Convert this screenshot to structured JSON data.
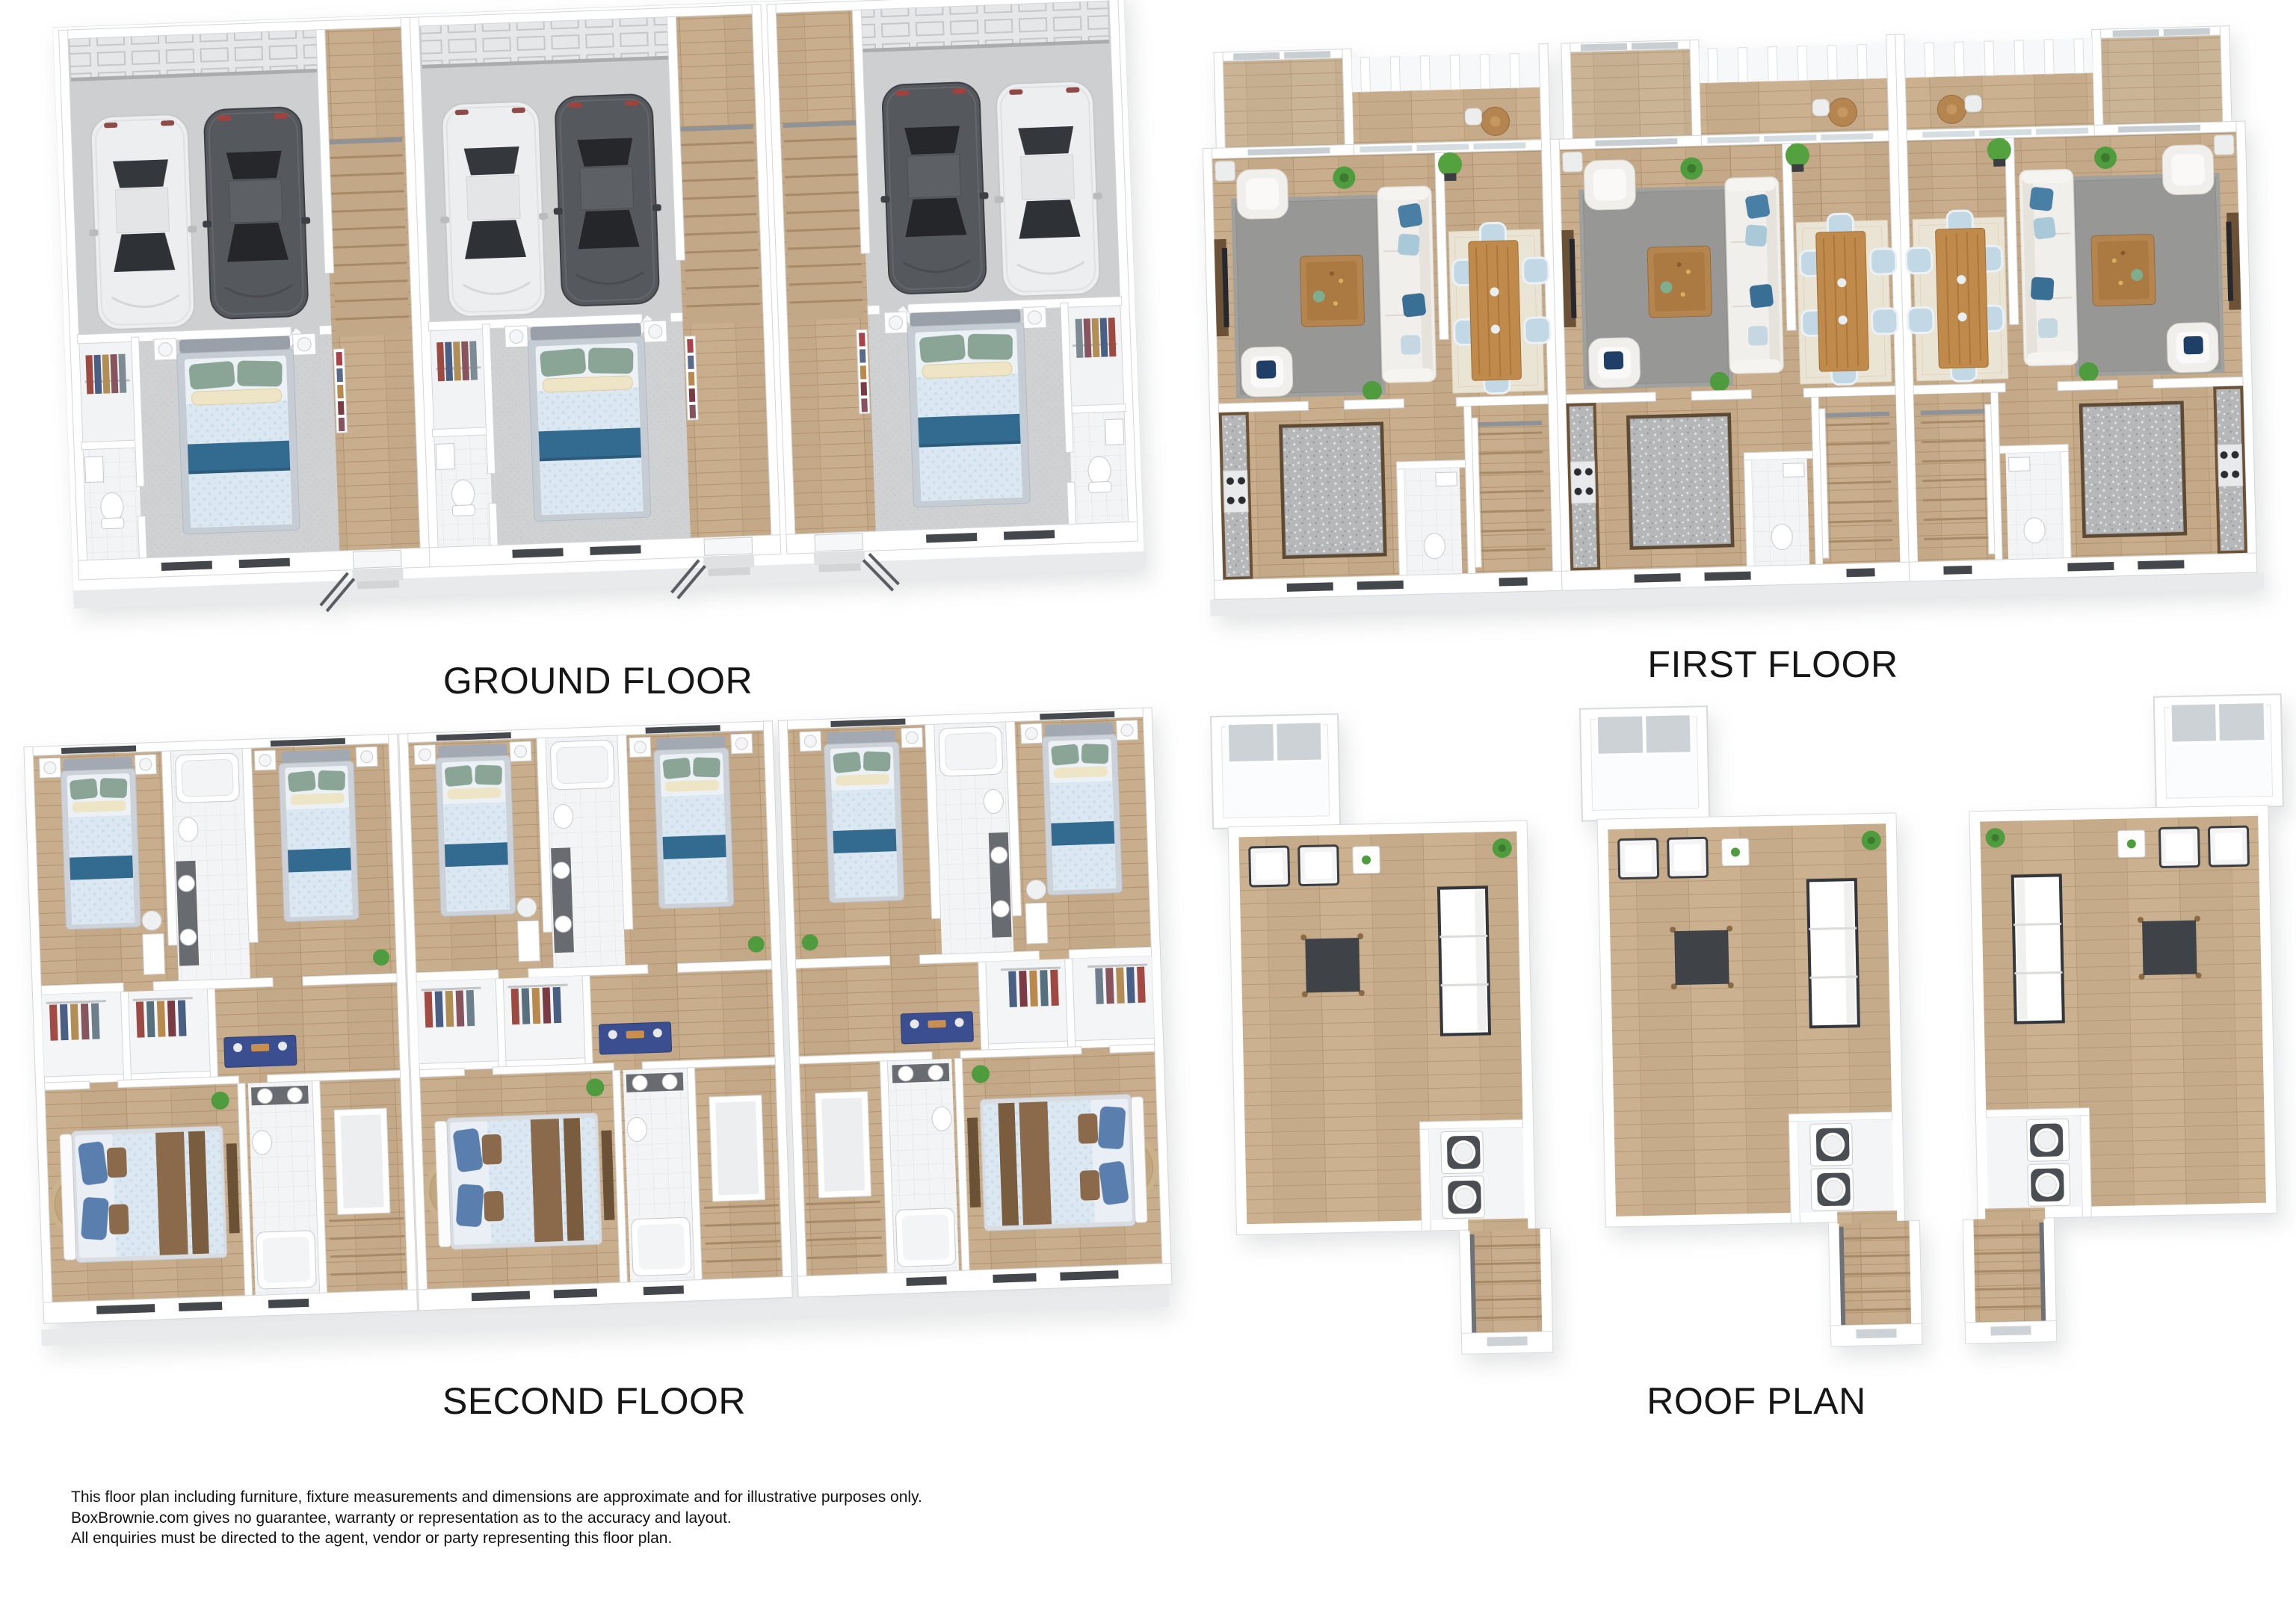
{
  "plans": {
    "ground_floor": {
      "label": "GROUND FLOOR"
    },
    "first_floor": {
      "label": "FIRST FLOOR"
    },
    "second_floor": {
      "label": "SECOND FLOOR"
    },
    "roof_plan": {
      "label": "ROOF PLAN"
    }
  },
  "disclaimer": {
    "lines": [
      "This floor plan including furniture, fixture measurements and dimensions are approximate and for illustrative purposes only.",
      "BoxBrownie.com gives no guarantee, warranty or representation as to the accuracy and layout.",
      "All enquiries must be directed to the agent, vendor or party representing this floor plan."
    ]
  },
  "colors": {
    "background": "#ffffff",
    "wall_white": "#ffffff",
    "wood_floor": "#c8ae8d",
    "concrete_floor": "#cdcfd1",
    "rug_gray": "#9d9e9c",
    "bed_teal_throw": "#336a90",
    "console_navy": "#3b4e90",
    "plant_green": "#4e9c3e",
    "granite_gray": "#b6b7b9",
    "car_dark": "#55585d",
    "car_white": "#eceef0",
    "label_text": "#161616"
  }
}
